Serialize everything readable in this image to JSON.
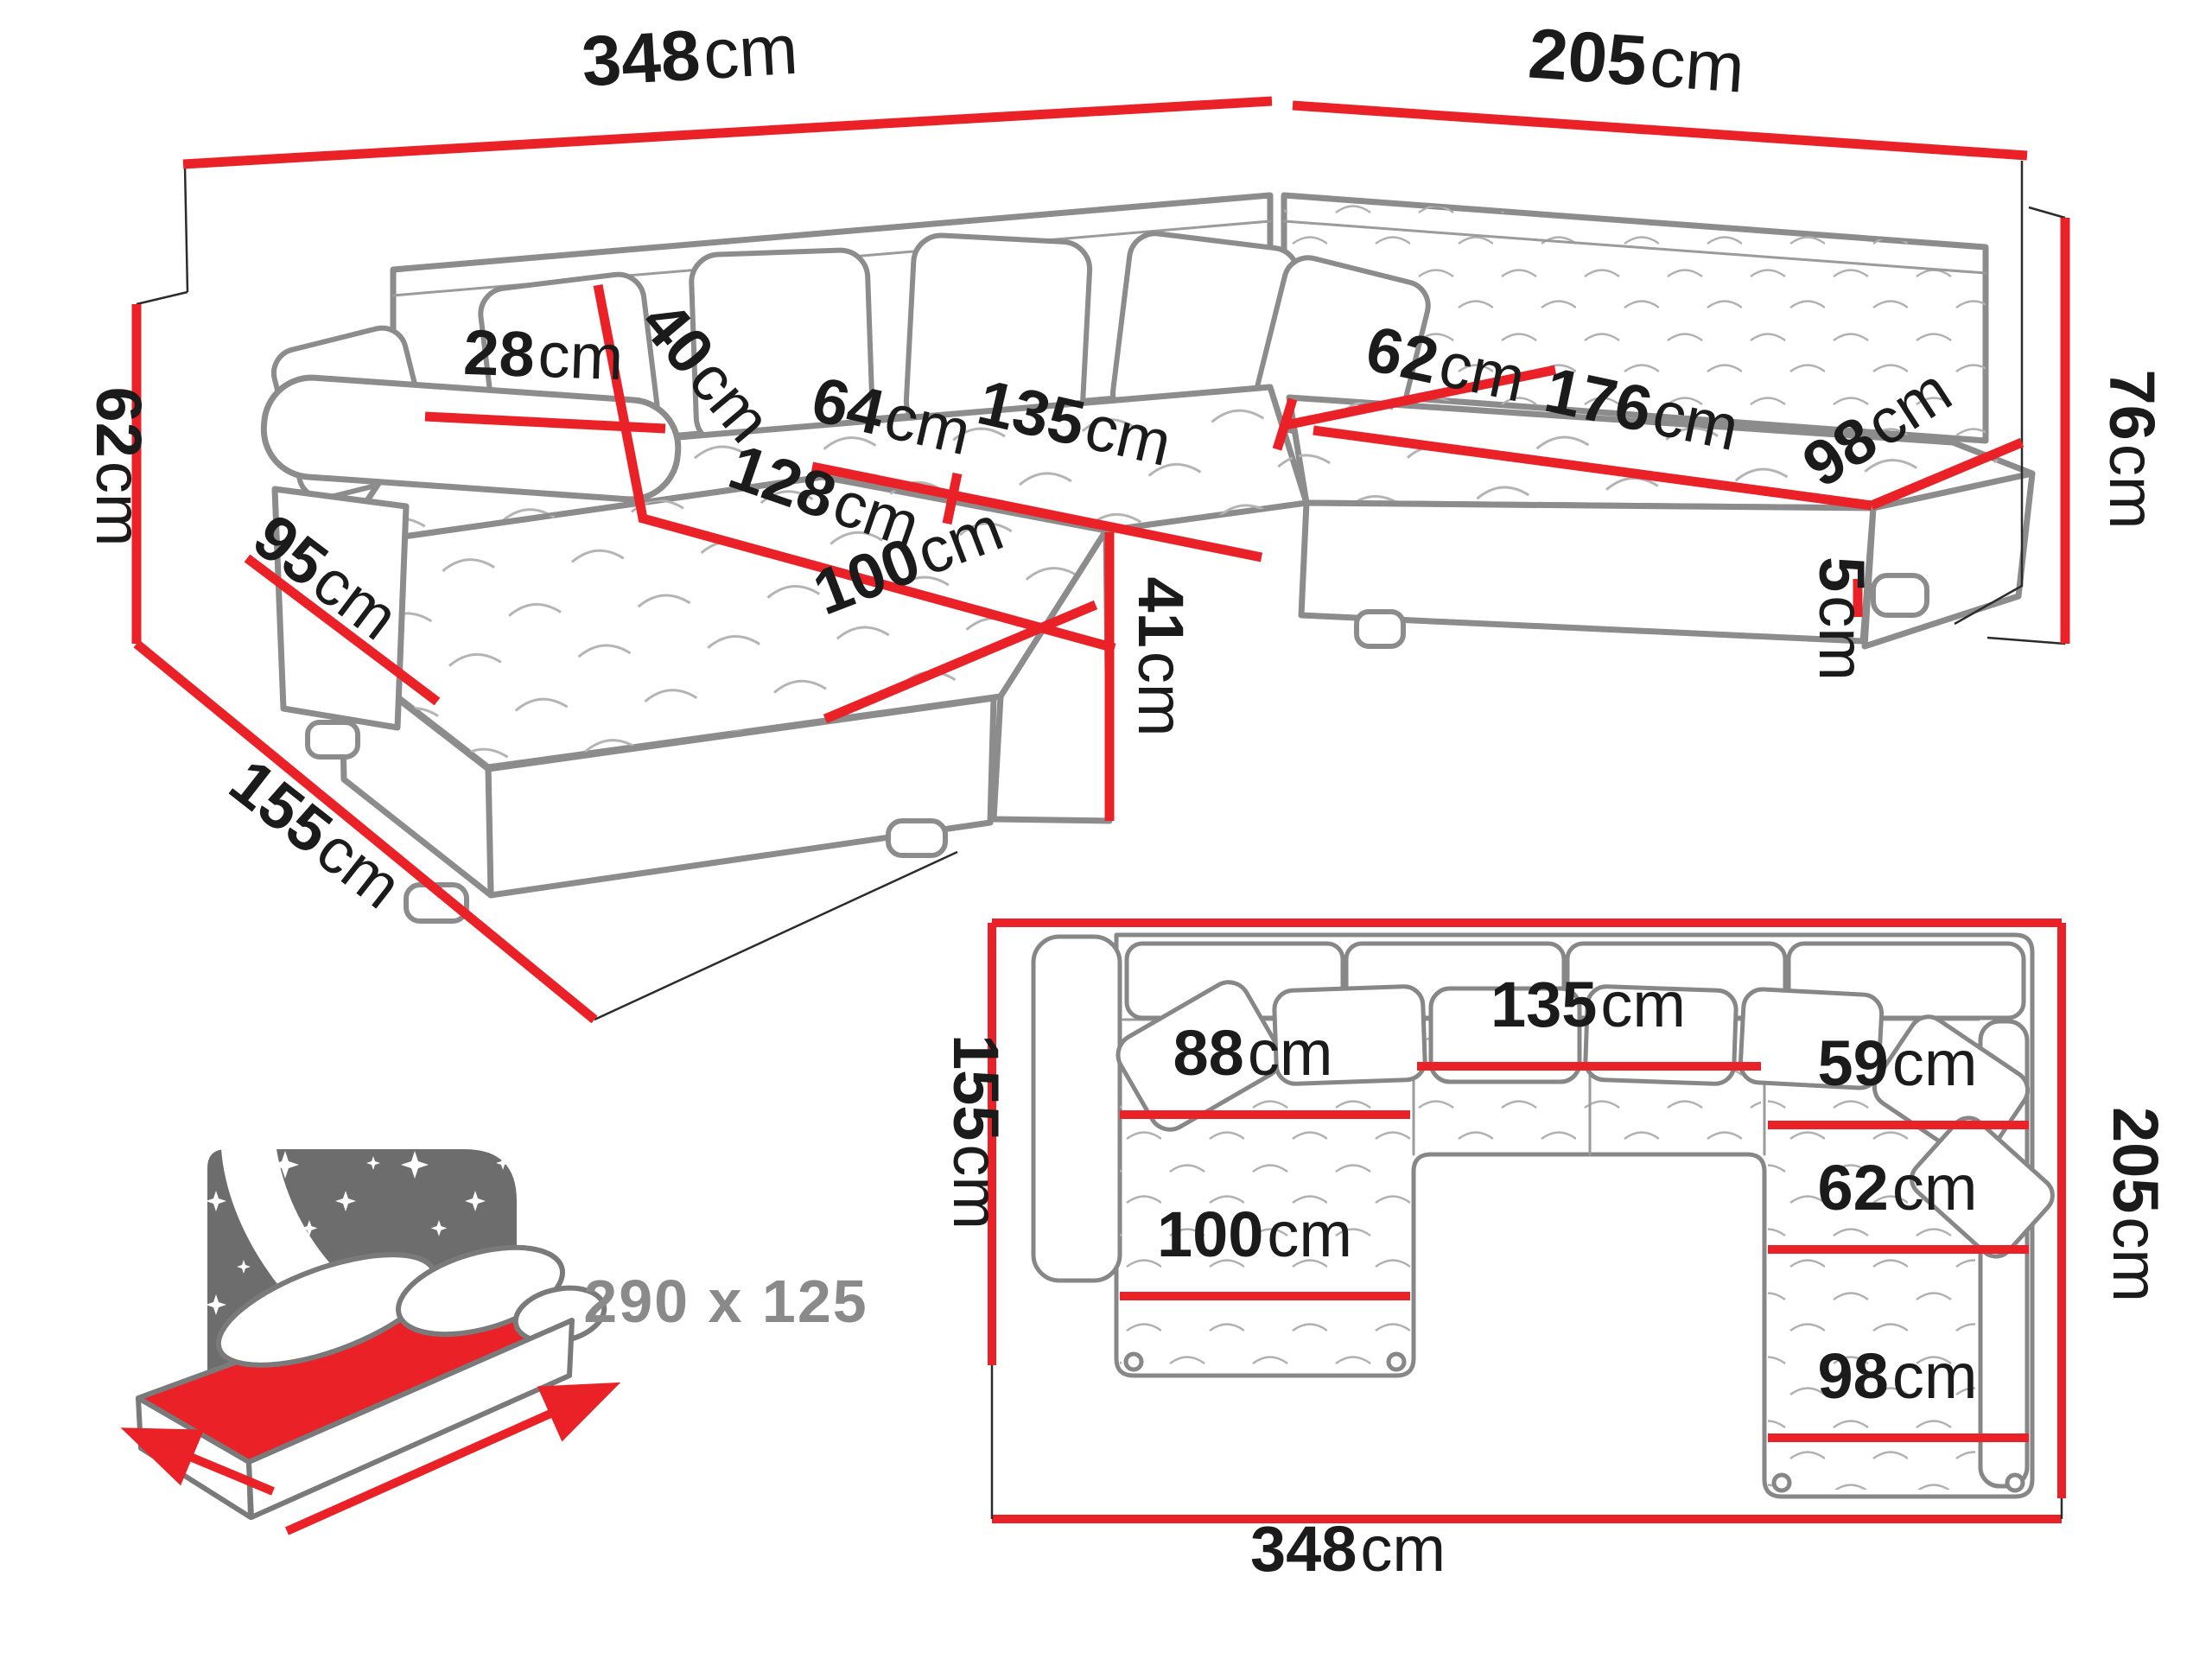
{
  "image_type": "furniture dimension diagram",
  "product": "U-shaped corner sofa bed with sleeping function",
  "colors": {
    "dimension_red": "#ea2127",
    "outline_gray": "#8c8c8c",
    "panel_gray": "#6d6d6d",
    "label_black": "#1b1b1b",
    "muted_gray": "#8a8a8a",
    "background": "#ffffff"
  },
  "perspective_view": {
    "dimensions": {
      "back_width": {
        "value": "348",
        "unit": "cm"
      },
      "right_back_width": {
        "value": "205",
        "unit": "cm"
      },
      "total_height": {
        "value": "76",
        "unit": "cm"
      },
      "armrest_height": {
        "value": "62",
        "unit": "cm"
      },
      "left_depth": {
        "value": "155",
        "unit": "cm"
      },
      "armrest_side_length": {
        "value": "95",
        "unit": "cm"
      },
      "armrest_width": {
        "value": "28",
        "unit": "cm"
      },
      "back_cushion_height": {
        "value": "40",
        "unit": "cm"
      },
      "seat_depth_left": {
        "value": "64",
        "unit": "cm"
      },
      "middle_seat_width": {
        "value": "135",
        "unit": "cm"
      },
      "chaise_length": {
        "value": "128",
        "unit": "cm"
      },
      "seat_depth_right": {
        "value": "62",
        "unit": "cm"
      },
      "right_seat_length": {
        "value": "176",
        "unit": "cm"
      },
      "right_seat_width": {
        "value": "98",
        "unit": "cm"
      },
      "chaise_width": {
        "value": "100",
        "unit": "cm"
      },
      "seat_height": {
        "value": "41",
        "unit": "cm"
      },
      "leg_height": {
        "value": "5",
        "unit": "cm"
      }
    }
  },
  "plan_view": {
    "dimensions": {
      "left_depth": {
        "value": "155",
        "unit": "cm"
      },
      "right_depth": {
        "value": "205",
        "unit": "cm"
      },
      "total_width": {
        "value": "348",
        "unit": "cm"
      },
      "left_seat_length": {
        "value": "88",
        "unit": "cm"
      },
      "middle_seat_width": {
        "value": "135",
        "unit": "cm"
      },
      "right_seat_depth_back": {
        "value": "59",
        "unit": "cm"
      },
      "right_seat_depth_mid": {
        "value": "62",
        "unit": "cm"
      },
      "right_seat_width_front": {
        "value": "98",
        "unit": "cm"
      },
      "chaise_width": {
        "value": "100",
        "unit": "cm"
      }
    }
  },
  "sleeping_function": {
    "icon": "bed-night-icon",
    "dimensions_label": "290 x 125"
  }
}
